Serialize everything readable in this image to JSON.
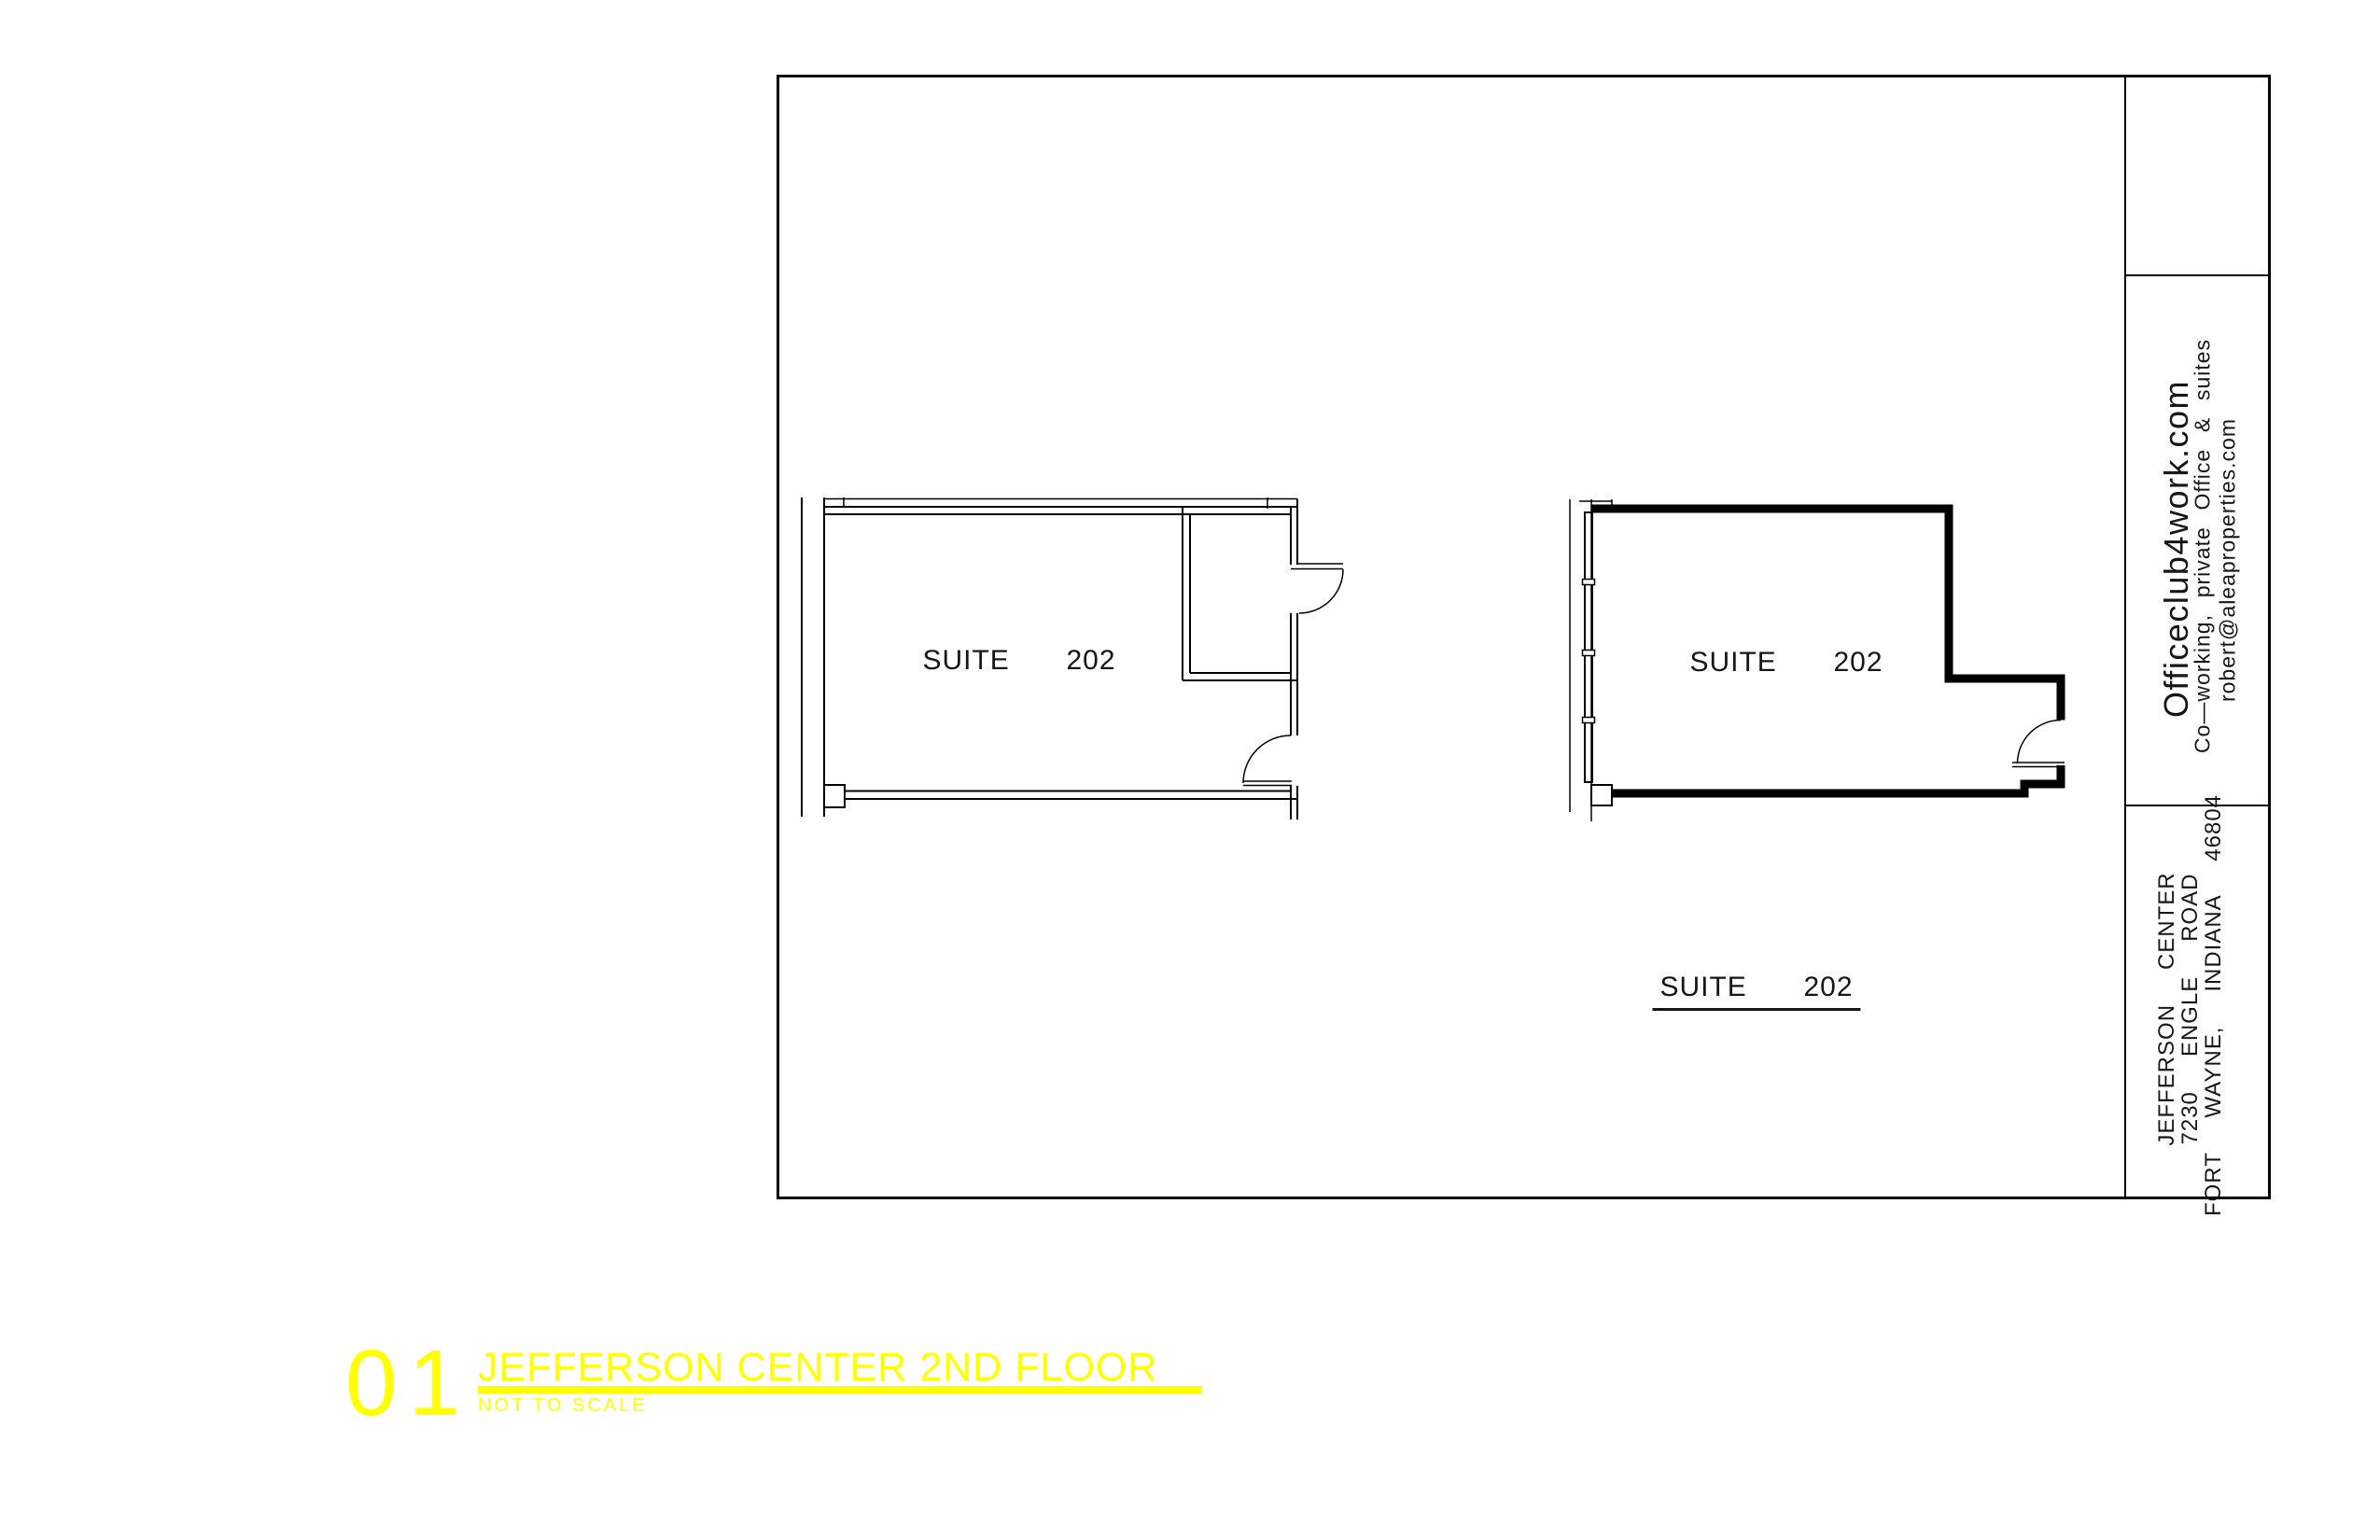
{
  "colors": {
    "accent_yellow": "#FFFF00",
    "line_black": "#000000",
    "paper_white": "#FFFFFF"
  },
  "title_block": {
    "website": "Officeclub4work.com",
    "tagline": "Co—working, private Office & suites",
    "email": "robert@aleaproperties.com",
    "building_name": "JEFFERSON  CENTER",
    "address_line1": "7230  ENGLE  ROAD",
    "address_line2": "FORT  WAYNE,  INDIANA  46804"
  },
  "plans": {
    "left_room_label": "SUITE  202",
    "right_room_label": "SUITE  202",
    "caption_label": "SUITE  202"
  },
  "footer": {
    "sheet_number": "01",
    "title": "JEFFERSON CENTER 2ND FLOOR",
    "subtitle": "NOT TO SCALE"
  }
}
